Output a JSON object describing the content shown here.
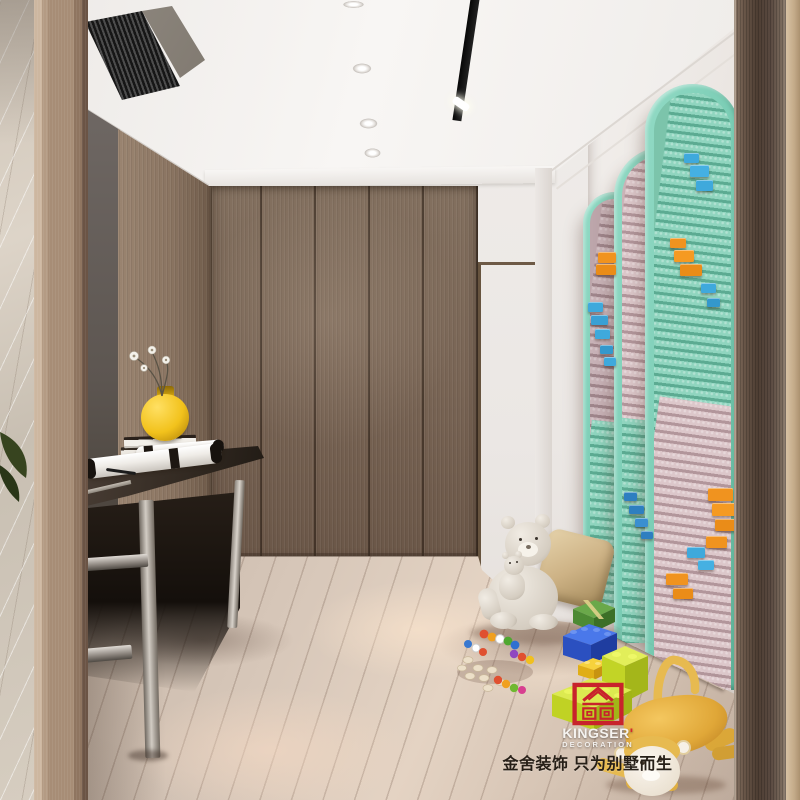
{
  "meta": {
    "description": "3D interior render of a children's hallway: brown wood wardrobe wall, dark console table with yellow round vase, white flowers, books and paper scrolls, mint-green Lego-style arched wall panels with pink, blue and orange bricks, light wood plank floor with toys — teddy bears, khaki pillow, green gift box, blue and lime building bricks, bead rattles and a yellow plush monkey. Ceiling has recessed downlights, a black track light and an AC vent grille."
  },
  "watermark": {
    "brand": "KINGSER",
    "brand_mark": "'",
    "brand_sub": "DECORATION",
    "tagline": "金舍装饰 只为别墅而生",
    "logo_color": "#c8232c",
    "text_color": "#f5f3f0",
    "tagline_color": "#261f17"
  },
  "palette": {
    "arch_frame_mint": "#7bcdb5",
    "brick_mint": "#90d5bf",
    "brick_pink": "#dcc7ca",
    "brick_blue": "#3fa9dc",
    "brick_orange": "#f0931f",
    "vase_yellow": "#f2c21c",
    "wardrobe_wood": "#7a6656",
    "floor_wood": "#d7c7b9",
    "monkey_yellow": "#e7ba50",
    "pillow_khaki": "#cdb285"
  }
}
